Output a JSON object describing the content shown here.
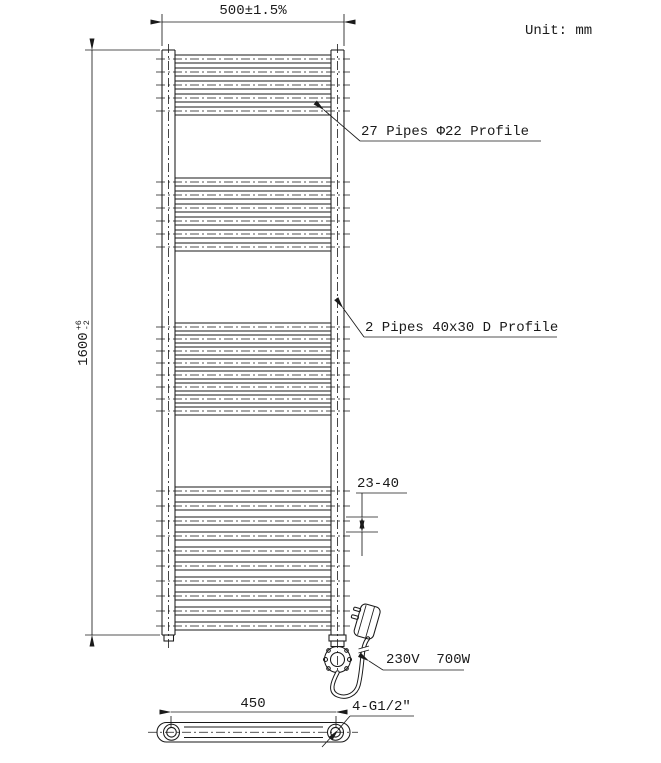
{
  "meta": {
    "unit_label": "Unit: mm",
    "colors": {
      "line": "#1a1a1a",
      "background": "#ffffff"
    }
  },
  "dims": {
    "width_label": "500±1.5%",
    "height_value": "1600",
    "height_tol_plus": "+6",
    "height_tol_minus": "-2",
    "pipe_gap": "23-40",
    "bottom_width": "450"
  },
  "labels": {
    "round_pipes": "27 Pipes Φ22 Profile",
    "d_pipes": "2 Pipes 40x30 D Profile",
    "power": "230V  700W",
    "thread": "4-G1/2″"
  },
  "radiator": {
    "pipe_x_start": 175,
    "pipe_x_end": 331,
    "centerline_x_start": 156,
    "centerline_x_end": 350,
    "pipe_groups": [
      {
        "count": 5,
        "start_y": 55,
        "pitch": 13,
        "pipe_h": 8
      },
      {
        "count": 6,
        "start_y": 178,
        "pitch": 13,
        "pipe_h": 8
      },
      {
        "count": 8,
        "start_y": 323,
        "pitch": 12,
        "pipe_h": 8
      },
      {
        "count": 10,
        "start_y": 487,
        "pitch": 15,
        "pipe_h": 8
      }
    ]
  }
}
